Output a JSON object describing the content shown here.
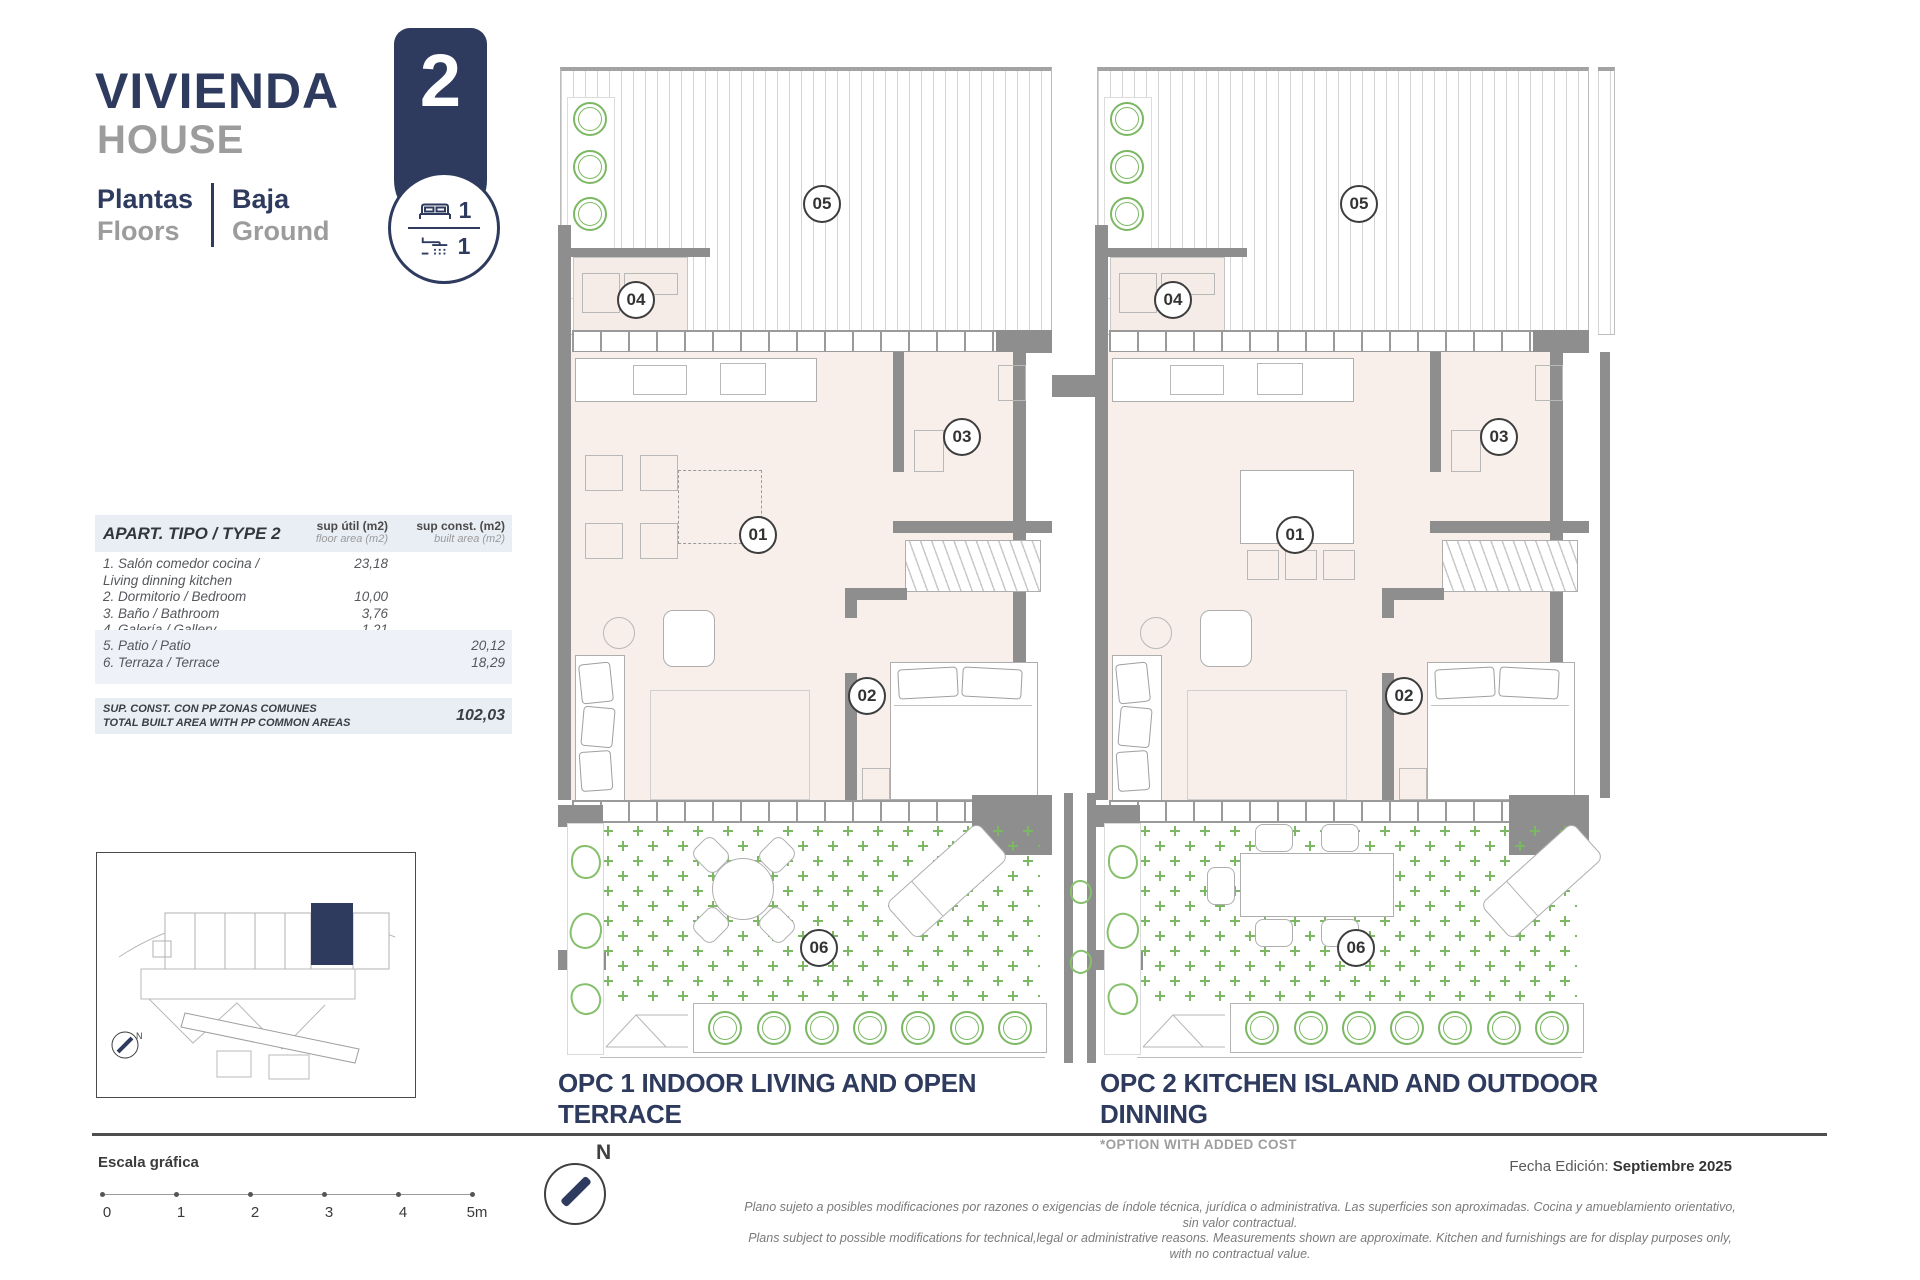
{
  "header": {
    "title_es": "VIVIENDA",
    "title_en": "HOUSE",
    "floors_label_es": "Plantas",
    "floors_label_en": "Floors",
    "floor_value_es": "Baja",
    "floor_value_en": "Ground"
  },
  "badge": {
    "number": "2",
    "bedrooms": "1",
    "bathrooms": "1"
  },
  "area_table": {
    "title": "APART. TIPO / TYPE 2",
    "col1_label": "sup útil (m2)",
    "col1_sublabel": "floor area (m2)",
    "col2_label": "sup const. (m2)",
    "col2_sublabel": "built area (m2)",
    "rows": [
      {
        "label": "1. Salón comedor cocina / Living dinning kitchen",
        "util": "23,18",
        "const": ""
      },
      {
        "label": "2. Dormitorio / Bedroom",
        "util": "10,00",
        "const": ""
      },
      {
        "label": "3. Baño / Bathroom",
        "util": "3,76",
        "const": ""
      },
      {
        "label": "4. Galería / Gallery",
        "util": "1,21",
        "const": ""
      },
      {
        "label": "5. Patio / Patio",
        "util": "",
        "const": "20,12"
      },
      {
        "label": "6. Terraza / Terrace",
        "util": "",
        "const": "18,29"
      }
    ],
    "total_label_es": "SUP. CONST. CON PP ZONAS COMUNES",
    "total_label_en": "TOTAL BUILT AREA WITH PP COMMON AREAS",
    "total_value": "102,03"
  },
  "plans": [
    {
      "caption": "OPC 1 INDOOR LIVING AND OPEN TERRACE",
      "note": "",
      "rooms": {
        "living": "01",
        "bedroom": "02",
        "bath": "03",
        "gallery": "04",
        "patio": "05",
        "terrace": "06"
      }
    },
    {
      "caption": "OPC 2 KITCHEN ISLAND AND OUTDOOR DINNING",
      "note": "*OPTION WITH ADDED COST",
      "rooms": {
        "living": "01",
        "bedroom": "02",
        "bath": "03",
        "gallery": "04",
        "patio": "05",
        "terrace": "06"
      }
    }
  ],
  "footer": {
    "scale_label": "Escala gráfica",
    "scale_ticks": [
      "0",
      "1",
      "2",
      "3",
      "4",
      "5m"
    ],
    "north_label": "N",
    "edition_label": "Fecha Edición: ",
    "edition_value": "Septiembre 2025",
    "disclaimer_es": "Plano sujeto a posibles modificaciones por razones o exigencias de índole técnica,  jurídica o administrativa. Las superficies son aproximadas. Cocina y amueblamiento orientativo, sin valor contractual.",
    "disclaimer_en": "Plans subject to possible modifications for technical,legal or administrative reasons. Measurements shown are approximate. Kitchen and furnishings are for display purposes only, with no contractual value."
  },
  "colors": {
    "navy": "#2e3b5e",
    "green": "#7cb863",
    "wall": "#8e8e8e",
    "floor": "#f8efeb"
  }
}
